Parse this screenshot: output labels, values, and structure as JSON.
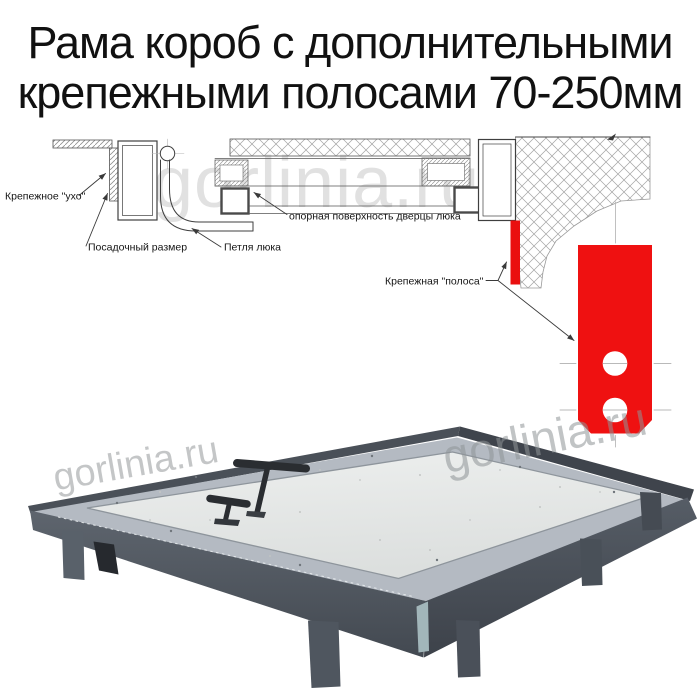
{
  "title": {
    "line1": "Рама короб с дополнительными",
    "line2": "крепежными полосами 70-250мм"
  },
  "watermark": {
    "text": "gorlinia.ru"
  },
  "diagram": {
    "labels": {
      "ear": "Крепежное \"ухо\"",
      "mount_size": "Посадочный размер",
      "hinge": "Петля люка",
      "support_surface": "опорная поверхность дверцы люка",
      "fastening_strip": "Крепежная \"полоса\""
    },
    "colors": {
      "strip_red": "#ee1111",
      "line": "#3f3f3f",
      "hatch": "#a0a0a0"
    }
  },
  "photo": {
    "colors": {
      "frame_metal": "#565c65",
      "frame_lip": "#b4bac2",
      "panel": "#e5e7e6",
      "handle": "#2a2d31"
    }
  }
}
